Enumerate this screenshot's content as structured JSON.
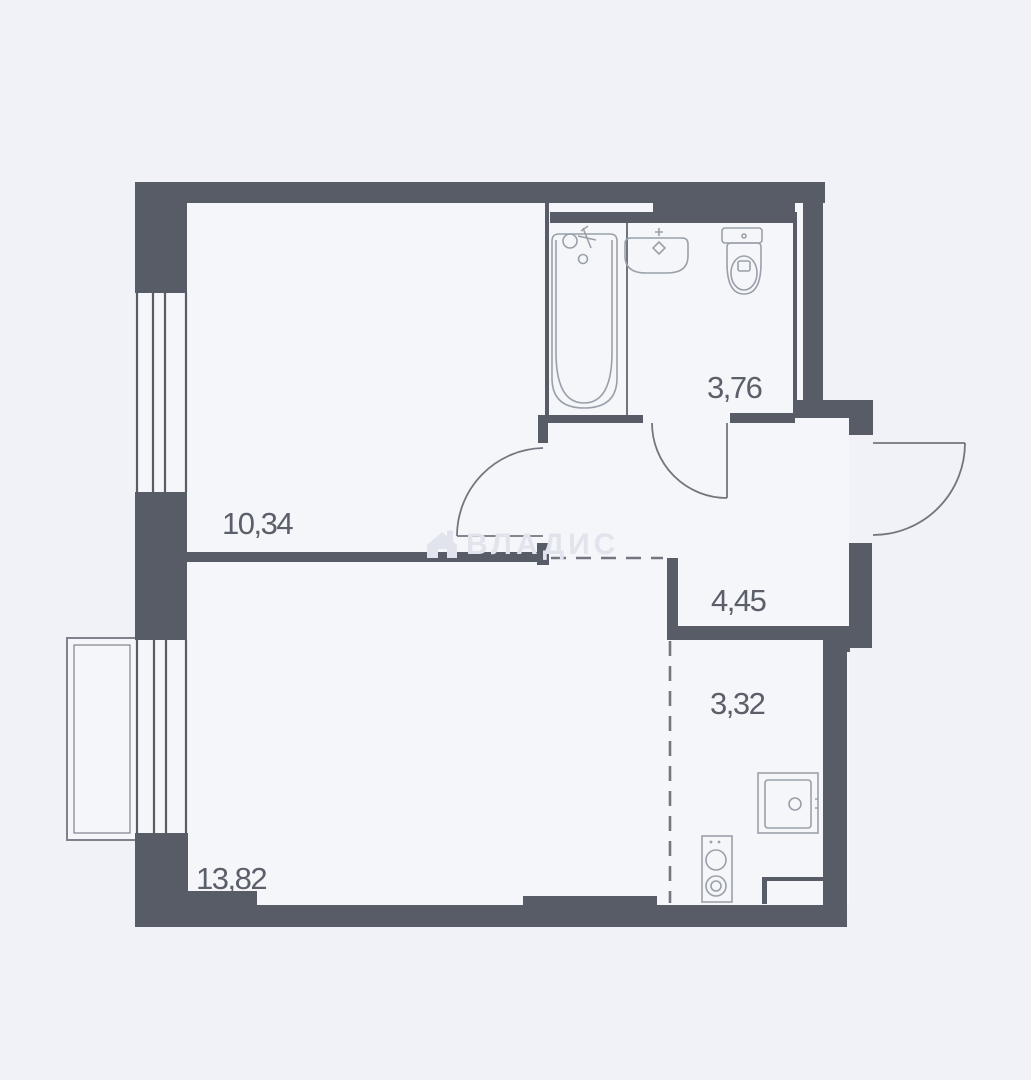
{
  "floorplan": {
    "type": "apartment-floor-plan",
    "watermark": {
      "text": "ВЛАДИС",
      "icon": "house-icon",
      "color": "#e1e4ec"
    },
    "rooms": [
      {
        "id": "room",
        "area_label": "10,34"
      },
      {
        "id": "bathroom",
        "area_label": "3,76"
      },
      {
        "id": "hallway",
        "area_label": "4,45"
      },
      {
        "id": "kitchen",
        "area_label": "3,32"
      },
      {
        "id": "living",
        "area_label": "13,82"
      }
    ],
    "fixtures": [
      "bathtub",
      "bathroom-sink",
      "toilet",
      "kitchen-sink",
      "stove",
      "counter"
    ],
    "features": [
      "entrance-door-arc",
      "bathroom-door-arc",
      "room-door-arc",
      "window-top-left",
      "window-bottom-left",
      "balcony",
      "dashed-zoning-lines"
    ],
    "colors": {
      "background": "#f0f2f7",
      "interior": "#f5f6fa",
      "wall": "#575c66",
      "label": "#5a5f69",
      "fixture_stroke": "#9aa0aa",
      "door_stroke": "#72777f",
      "watermark": "#e1e4ec"
    }
  }
}
